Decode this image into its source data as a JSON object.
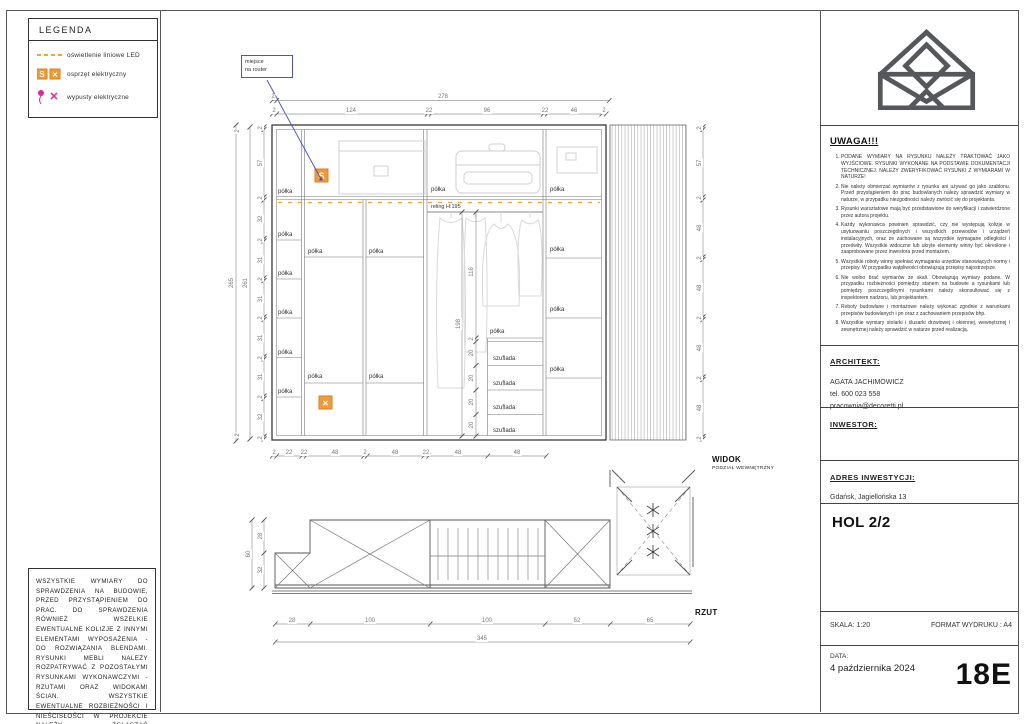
{
  "colors": {
    "accent_orange": "#F29A38",
    "accent_magenta": "#E2229E",
    "accent_blue": "#4A4AC0",
    "sketch_gray": "#D6D6D6"
  },
  "legend": {
    "title": "LEGENDA",
    "items": [
      {
        "icon": "led-strip",
        "label": "oświetlenie liniowe LED"
      },
      {
        "icon": "electrical-equipment",
        "label": "osprzęt elektryczny"
      },
      {
        "icon": "electrical-outlets",
        "label": "wypusty elektryczne"
      }
    ]
  },
  "symbols": {
    "outlet_s": "S",
    "outlet_x": "✕",
    "cross": "✕"
  },
  "disclaimer": "WSZYSTKIE WYMIARY DO SPRAWDZENIA NA BUDOWIE, PRZED PRZYSTĄPIENIEM DO PRAC. DO SPRAWDZENIA RÓWNIEŻ WSZELKIE EWENTUALNE KOLIZJE Z INNYMI ELEMENTAMI WYPOSAŻENIA - DO ROZWIĄZANIA BLENDAMI. RYSUNKI MEBLI NALEŻY ROZPATRYWAĆ Z POZOSTAŁYMI RYSUNKAMI WYKONAWCZYMI - RZUTAMI ORAZ WIDOKAMI ŚCIAN. WSZYSTKIE EWENTUALNE ROZBIEŻNOŚCI I NIEŚCISŁOŚCI W PROJEKCIE NALEŻY ZGŁASZAĆ PROJEKTANTOWI.",
  "notes": {
    "title": "UWAGA!!!",
    "items": [
      "PODANE WYMIARY NA RYSUNKU NALEŻY TRAKTOWAĆ JAKO WYJŚCIOWE. RYSUNKI WYKONANE NA PODSTAWIE DOKUMENTACJI TECHNICZNEJ. NALEŻY ZWERYFIKOWAĆ RYSUNKI Z WYMIARAMI W NATURZE!",
      "Nie należy obmierzać wymiarów z rysunku ani używać go jako szablonu. Przed przystąpieniem do prac budowlanych należy sprawdzić wymiary w naturze, w przypadku niezgodności należy zwrócić się do projektanta.",
      "Rysunki warsztatowe mają być przedstawione do weryfikacji i zatwierdzone przez autora projektu.",
      "Każdy wykonawca powinien sprawdzić, czy nie występują kolizje w usytuowaniu poszczególnych i wszystkich przewodów i urządzeń instalacyjnych, oraz że zachowane są wszystkie wymagane odległości i prześwity. Wszystkie widoczne lub ukryte elementy winny być określone i zaaprobowane przez inwestora przed montażem.",
      "Wszystkie roboty winny spełniać wymagania urzędów stanowiących normy i przepisy. W przypadku wątpliwości obowiązują przepisy najostrzejsze.",
      "Nie wolno brać wymiarów ze skali. Obowiązują wymiary podane. W przypadku rozbieżności pomiędzy stanem na budowie a rysunkami lub pomiędzy poszczególnymi rysunkami należy skonsultować się z inspektorem nadzoru, lub projektantem.",
      "Roboty budowlane i montażowe należy wykonać zgodnie z warunkami przepisów budowlanych i pn oraz z zachowaniem przepisów bhp.",
      "Wszystkie wymiary stolarki i ślusarki drzwiowej i okiennej, wewnętrznej i zewnętrznej należy sprawdzić w naturze przed realizacją."
    ]
  },
  "titleblock": {
    "architect_label": "ARCHITEKT:",
    "architect_name": "AGATA JACHIMOWICZ",
    "architect_phone": "tel. 600 023 558",
    "architect_email": "pracownia@decoretti.pl",
    "investor_label": "INWESTOR:",
    "address_label": "ADRES INWESTYCJI:",
    "address_value": "Gdańsk, Jagiellońska 13",
    "drawing_title": "HOL 2/2",
    "scale_label": "SKALA: 1:20",
    "format_label": "FORMAT WYDRUKU : A4",
    "date_label": "DATA:",
    "date_value": "4 października 2024",
    "sheet_code": "18E"
  },
  "widok": {
    "callout_line1": "miejsce",
    "callout_line2": "na router",
    "caption": "WIDOK",
    "caption_sub": "PODZIAŁ WEWNĘTRZNY",
    "reling_label": "reling H:195",
    "shelf_label": "półka",
    "drawer_label": "szuflada",
    "dims": {
      "wall": "2",
      "total_width": "278",
      "total_height": "265",
      "inner_height": "261",
      "top": [
        "2",
        "124",
        "22",
        "96",
        "22",
        "46",
        "2"
      ],
      "left": [
        "2",
        "57",
        "2",
        "32",
        "2",
        "31",
        "2",
        "31",
        "2",
        "31",
        "2",
        "31",
        "2",
        "32",
        "2"
      ],
      "right": [
        "2",
        "57",
        "2",
        "48",
        "2",
        "48",
        "2",
        "48",
        "2",
        "48",
        "2"
      ],
      "bottom": [
        "2",
        "22",
        "22",
        "48",
        "2",
        "48",
        "22",
        "48",
        "48"
      ],
      "hang_total": "198",
      "hang_clear": "116",
      "drawers": [
        "2",
        "20",
        "20",
        "20",
        "20"
      ]
    }
  },
  "rzut": {
    "caption": "RZUT",
    "bottom": [
      "28",
      "100",
      "100",
      "52",
      "65"
    ],
    "total": "345",
    "left": [
      "28",
      "32"
    ],
    "left_total": "60"
  }
}
